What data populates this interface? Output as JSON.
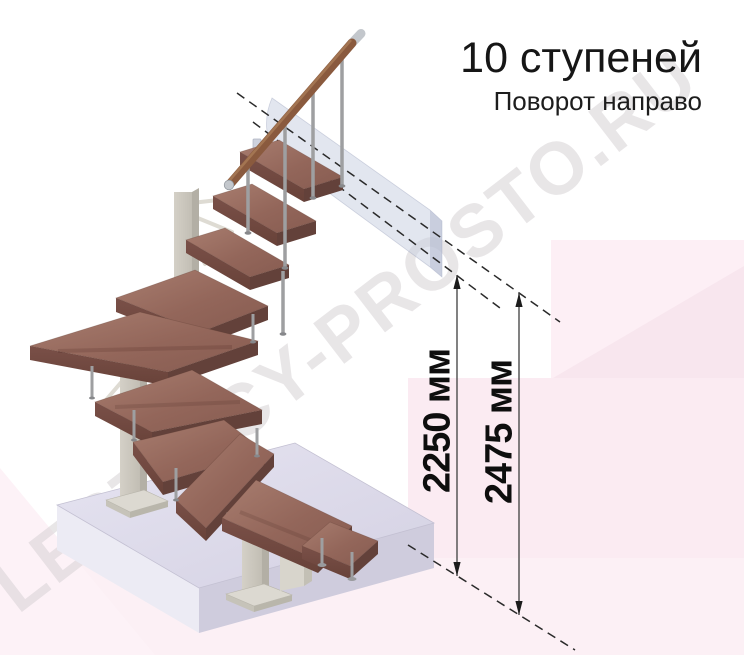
{
  "title": "10 ступеней",
  "subtitle": "Поворот направо",
  "watermark": "LESTNICY-PROSTO.RU",
  "dimensions": [
    {
      "id": "height-to-platform",
      "label": "2250 мм"
    },
    {
      "id": "height-overall",
      "label": "2475 мм"
    }
  ],
  "illustration": {
    "steps_count": "10",
    "colors": {
      "wood_top": "#93665a",
      "wood_edge": "#6a443c",
      "handrail": "#8a5a3e",
      "metal_baluster": "#9e9fa1",
      "steel_column": "#cdc9c0",
      "base_slab": "#dbd8e7",
      "wall_panel": "#c6cde0",
      "pink_backdrop": "#fbecf3",
      "dimension_text": "#0e0e0e",
      "watermark_color": "#d7d2d5"
    }
  }
}
